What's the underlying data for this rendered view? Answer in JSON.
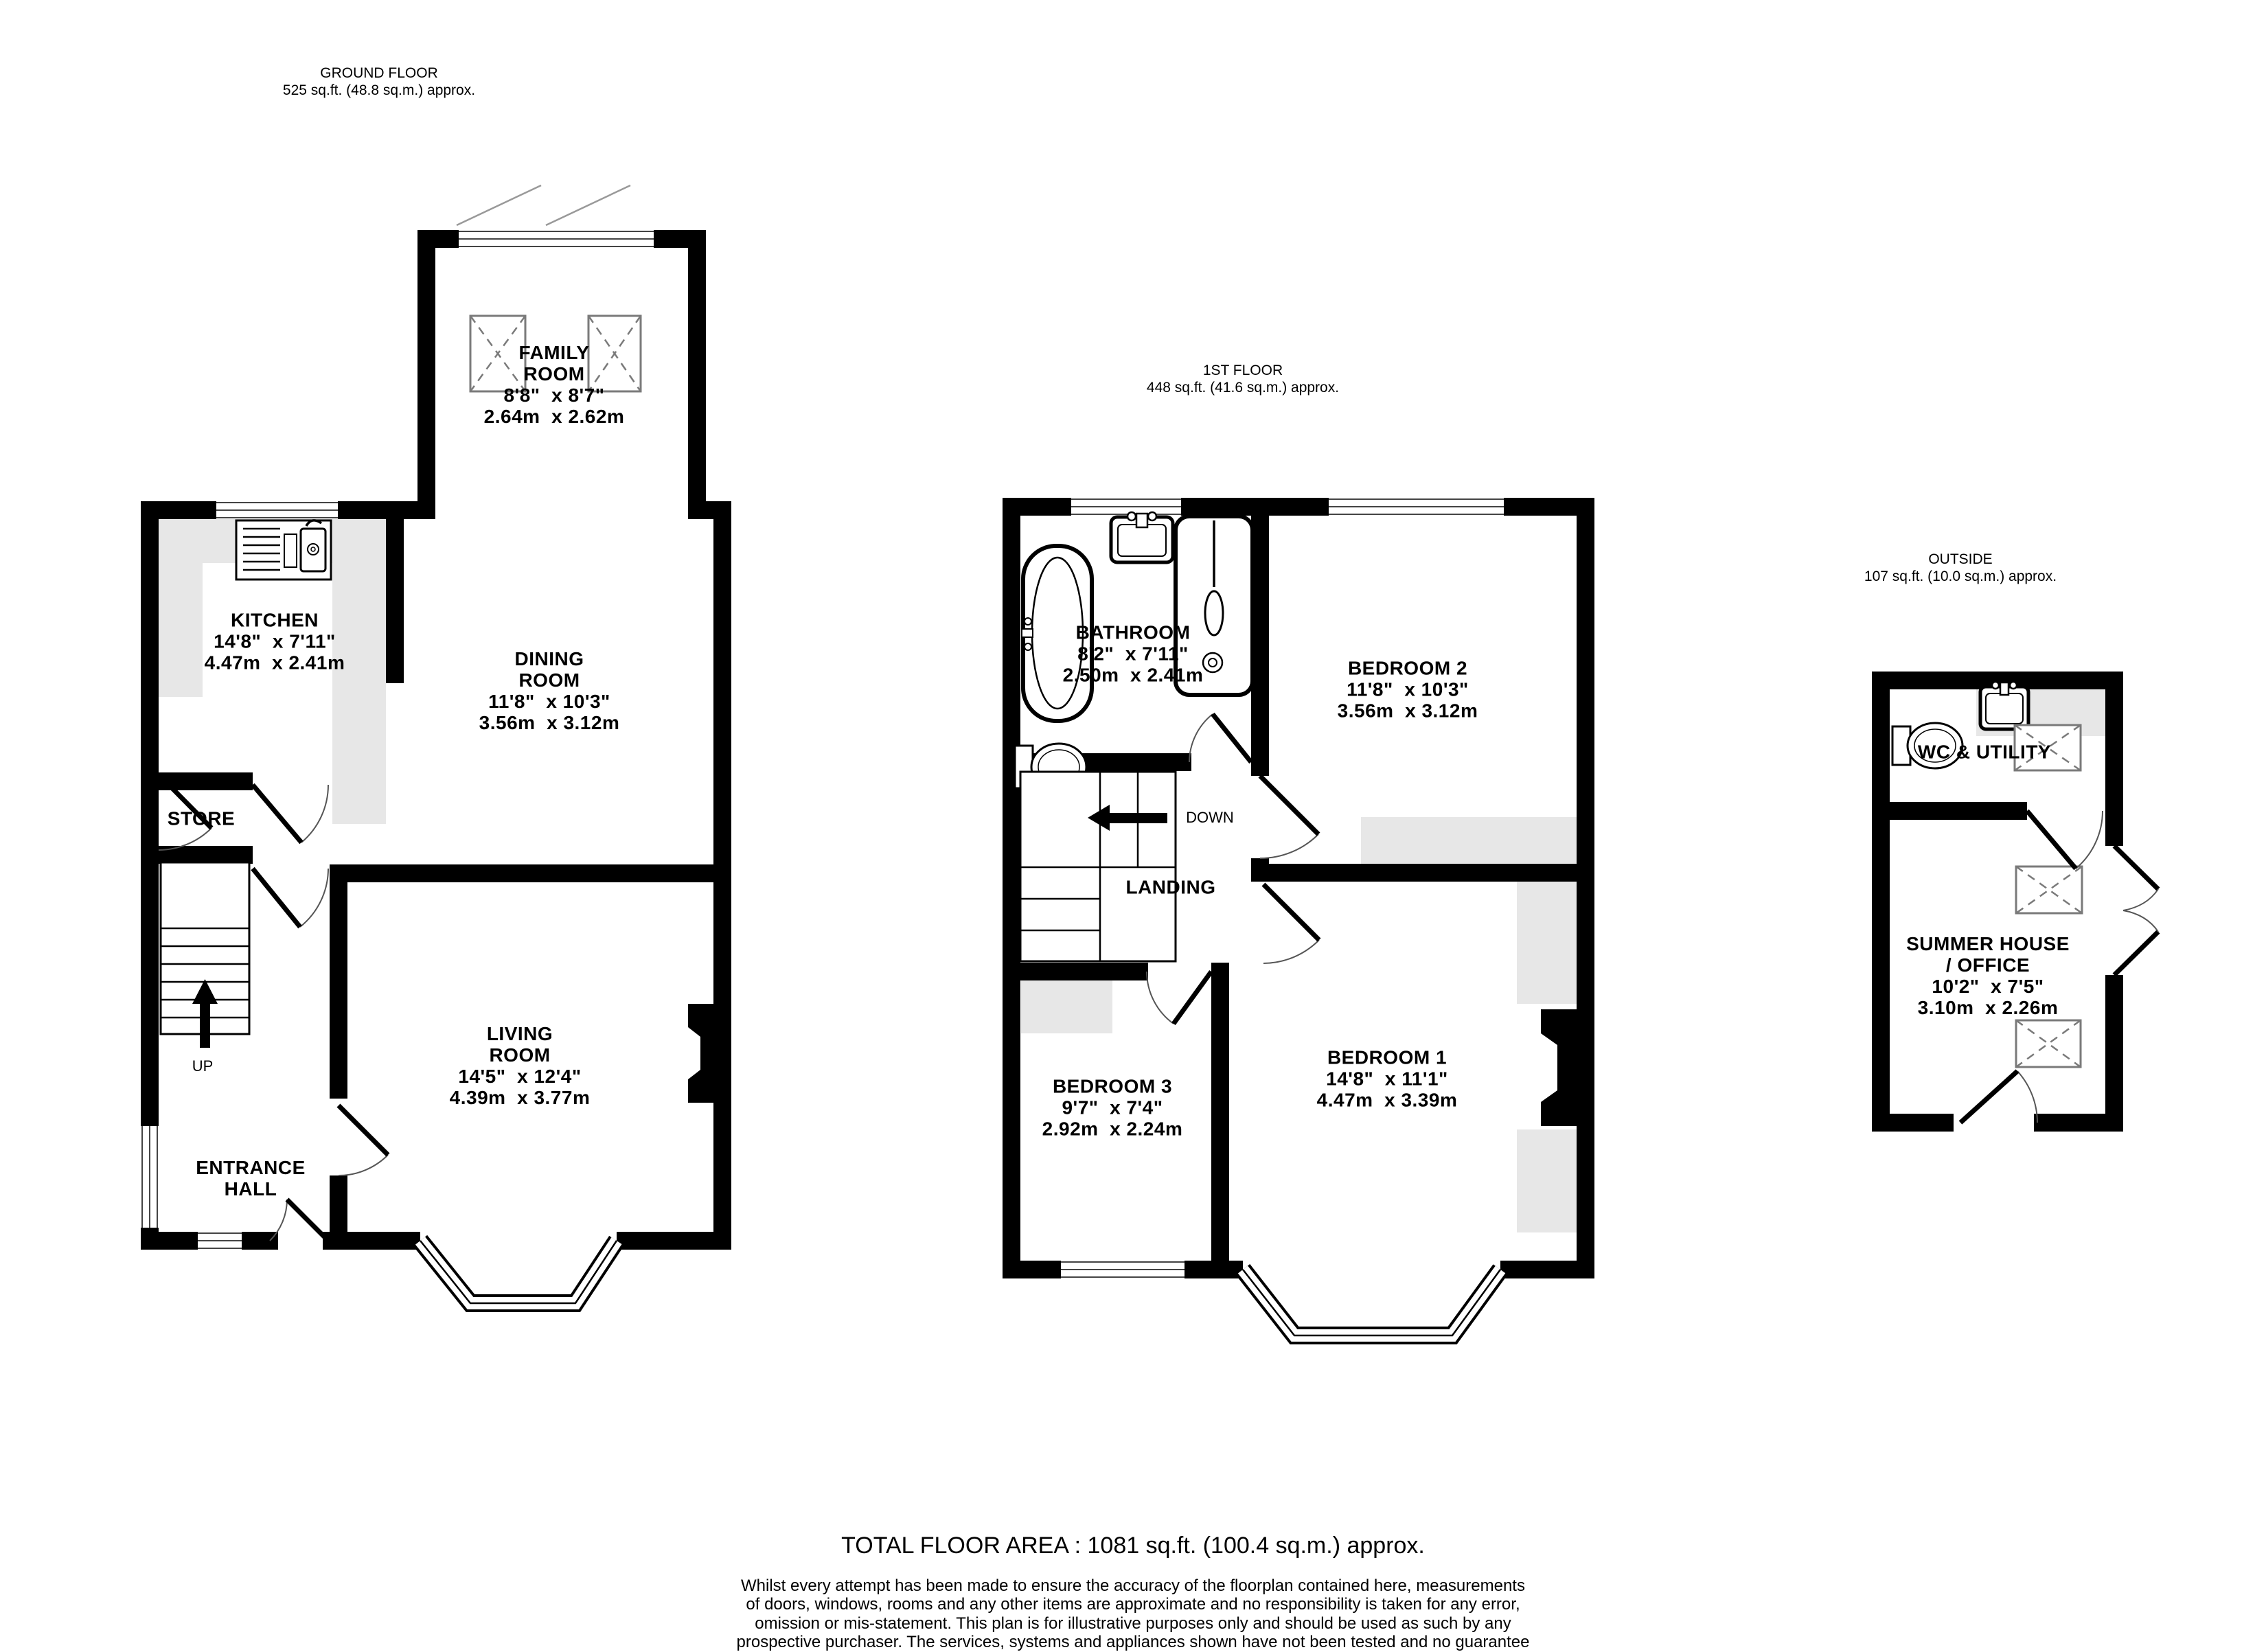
{
  "floors": {
    "ground": {
      "title": "GROUND FLOOR",
      "area": "525 sq.ft. (48.8 sq.m.) approx.",
      "up_label": "UP",
      "rooms": {
        "family": {
          "name": "FAMILY\nROOM",
          "imperial": "8'8\"  x 8'7\"",
          "metric": "2.64m  x 2.62m"
        },
        "kitchen": {
          "name": "KITCHEN",
          "imperial": "14'8\"  x 7'11\"",
          "metric": "4.47m  x 2.41m"
        },
        "dining": {
          "name": "DINING\nROOM",
          "imperial": "11'8\"  x 10'3\"",
          "metric": "3.56m  x 3.12m"
        },
        "store": {
          "name": "STORE"
        },
        "entrance": {
          "name": "ENTRANCE\nHALL"
        },
        "living": {
          "name": "LIVING\nROOM",
          "imperial": "14'5\"  x 12'4\"",
          "metric": "4.39m  x 3.77m"
        }
      }
    },
    "first": {
      "title": "1ST FLOOR",
      "area": "448 sq.ft. (41.6 sq.m.) approx.",
      "down_label": "DOWN",
      "rooms": {
        "bathroom": {
          "name": "BATHROOM",
          "imperial": "8'2\"  x 7'11\"",
          "metric": "2.50m  x 2.41m"
        },
        "bedroom2": {
          "name": "BEDROOM 2",
          "imperial": "11'8\"  x 10'3\"",
          "metric": "3.56m  x 3.12m"
        },
        "bedroom3": {
          "name": "BEDROOM 3",
          "imperial": "9'7\"  x 7'4\"",
          "metric": "2.92m  x 2.24m"
        },
        "bedroom1": {
          "name": "BEDROOM 1",
          "imperial": "14'8\"  x 11'1\"",
          "metric": "4.47m  x 3.39m"
        },
        "landing": {
          "name": "LANDING"
        }
      }
    },
    "outside": {
      "title": "OUTSIDE",
      "area": "107 sq.ft. (10.0 sq.m.) approx.",
      "rooms": {
        "wc": {
          "name": "WC & UTILITY"
        },
        "summer": {
          "name": "SUMMER HOUSE\n/ OFFICE",
          "imperial": "10'2\"  x 7'5\"",
          "metric": "3.10m  x 2.26m"
        }
      }
    }
  },
  "footer": {
    "total": "TOTAL FLOOR AREA : 1081 sq.ft. (100.4 sq.m.) approx.",
    "disclaimer": "Whilst every attempt has been made to ensure the accuracy of the floorplan contained here, measurements\nof doors, windows, rooms and any other items are approximate and no responsibility is taken for any error,\nomission or mis-statement. This plan is for illustrative purposes only and should be used as such by any\nprospective purchaser. The services, systems and appliances shown have not been tested and no guarantee\nas to their operability or efficiency can be given.",
    "made_with": "Made with Metropix ©2026"
  },
  "colors": {
    "wall": "#000000",
    "counter": "#e7e7e7",
    "hatch": "#7a7a7a",
    "arc": "#555555"
  }
}
